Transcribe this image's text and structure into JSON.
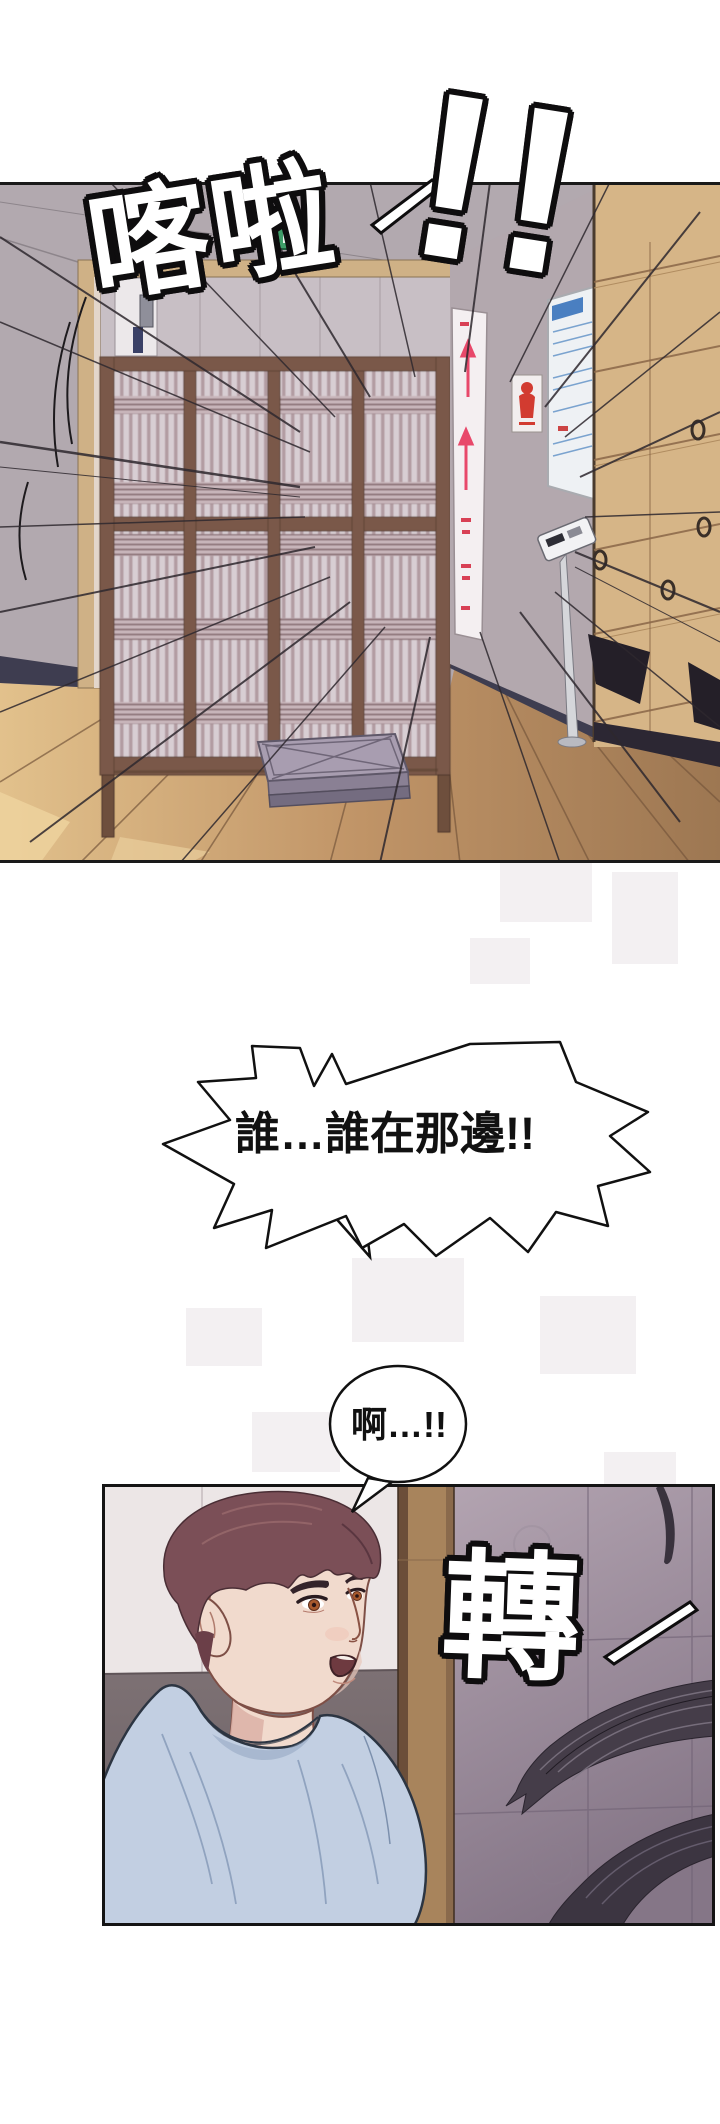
{
  "page": {
    "width": 720,
    "height": 2124,
    "background": "#ffffff"
  },
  "panel1": {
    "label": "hallway with sliding lattice door",
    "sfx": {
      "text": "喀啦",
      "bangs": "!!"
    },
    "colors": {
      "wall": "#b2a9af",
      "door_frame": "#cfb186",
      "lattice_wood": "#7a5948",
      "lattice_paper": "#d8ced3",
      "lockers": "#d6b587",
      "floor_light": "#e2c18c",
      "floor_dark": "#9d7752",
      "exit_sign": "#3f9e69",
      "poster_accent": "#d23b30",
      "banner_accent": "#e8486a",
      "mat": "#a89db0",
      "baseboard": "#3e3d50"
    }
  },
  "bubbles": {
    "shout": {
      "text": "誰…誰在那邊!!"
    },
    "gasp": {
      "text": "啊…!!"
    }
  },
  "panel2": {
    "label": "startled young man turning his head",
    "sfx": {
      "text": "轉"
    },
    "colors": {
      "tile_wall": "#a394a2",
      "white_wall": "#ece6e6",
      "dark_wall": "#766a6e",
      "pillar": "#a8845c",
      "hair": "#7b4f57",
      "skin": "#f1dacd",
      "shirt": "#c2cfe2",
      "stranger_hair": "#453d49"
    }
  }
}
